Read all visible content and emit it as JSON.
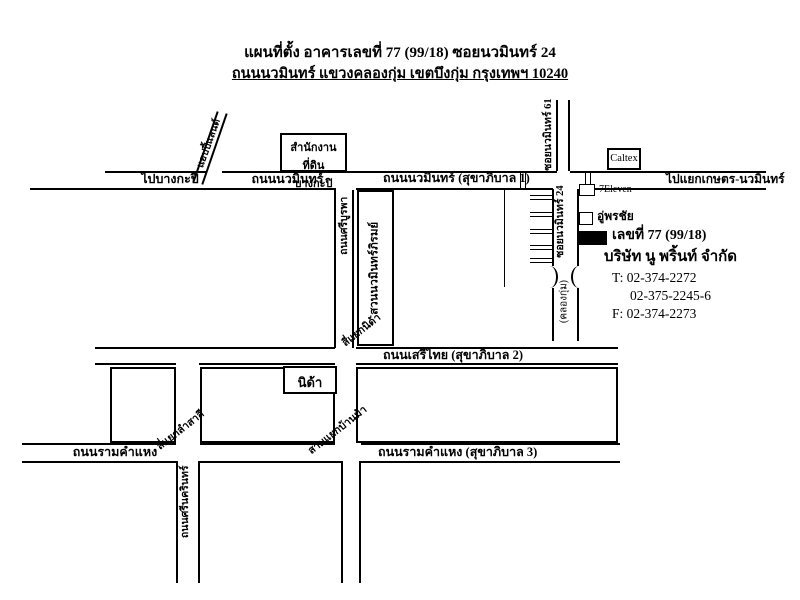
{
  "title": {
    "line1": "แผนที่ตั้ง อาคารเลขที่ 77 (99/18) ซอยนวมินทร์ 24",
    "line2": "ถนนนวมินทร์ แขวงคลองกุ่ม เขตบึงกุ่ม กรุงเทพฯ 10240"
  },
  "roads": {
    "to_bangkapi": "ไปบางกะปิ",
    "nawamin": "ถนนนวมินทร์",
    "nawamin_sukhapiban1": "ถนนนวมินทร์ (สุขาภิบาล 1)",
    "to_kaset_nawamin": "ไปแยกเกษตร-นวมินทร์",
    "happyland": "แฮปปี้แลนด์",
    "soi_nawamin_61": "ซอยนวมินทร์ 61",
    "soi_nawamin_24": "ซอยนวมินทร์ 24",
    "si_burapha": "ถนนศรีบูรพา",
    "serithai_sukhapiban2": "ถนนเสรีไทย (สุขาภิบาล 2)",
    "ramkhamhaeng": "ถนนรามคำแหง",
    "ramkhamhaeng_sukhapiban3": "ถนนรามคำแหง (สุขาภิบาล 3)",
    "srinakarin": "ถนนศรีนครินทร์",
    "khlong_kum": "(คลองกุ่ม)"
  },
  "junctions": {
    "si_yaek_nida": "สี่แยกนิด้า",
    "si_yaek_lam_sali": "สี่แยกลำสาลี",
    "sam_yaek_ban_ma": "สามแยกบ้านม้า"
  },
  "places": {
    "land_office_line1": "สำนักงานที่ดิน",
    "land_office_line2": "บางกะปิ",
    "caltex": "Caltex",
    "seven_eleven": "7Eleven",
    "pornchai_garage": "อู่พรชัย",
    "nawamin_phirom_park": "สวนนวมินทร์ภิรมย์",
    "nida": "นิด้า"
  },
  "building": {
    "address": "เลขที่ 77 (99/18)",
    "company": "บริษัท นู พริ้นท์ จำกัด",
    "tel1": "T: 02-374-2272",
    "tel2": "02-375-2245-6",
    "fax": "F: 02-374-2273"
  },
  "colors": {
    "line": "#000000",
    "background": "#ffffff"
  }
}
